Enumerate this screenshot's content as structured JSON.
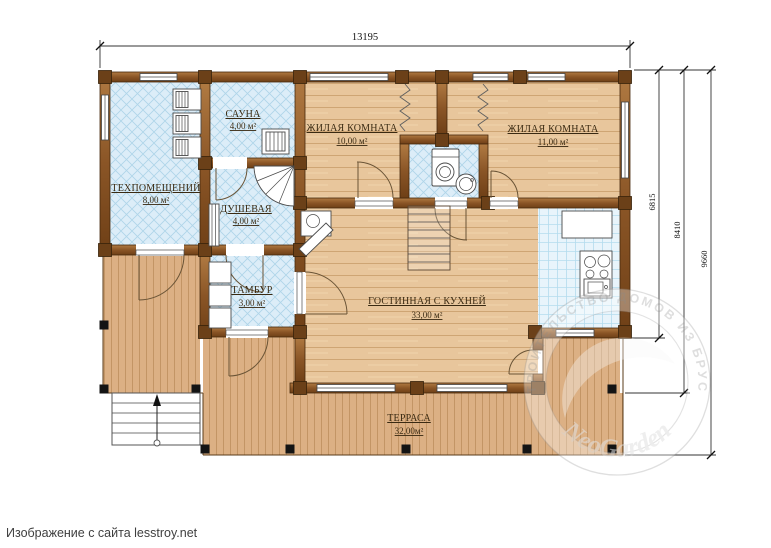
{
  "caption": {
    "text": "Изображение с сайта lesstroy.net"
  },
  "dimensions": {
    "width_top": "13195",
    "right": {
      "d1": "6815",
      "d2": "8410",
      "d3": "9660"
    }
  },
  "rooms": {
    "tech": {
      "name": "ТЕХПОМЕЩЕНИЙ",
      "area": "8,00 м²"
    },
    "sauna": {
      "name": "САУНА",
      "area": "4,00 м²"
    },
    "shower": {
      "name": "ДУШЕВАЯ",
      "area": "4,00 м²"
    },
    "bedroom1": {
      "name": "ЖИЛАЯ КОМНАТА",
      "area": "10,00 м²"
    },
    "bedroom2": {
      "name": "ЖИЛАЯ КОМНАТА",
      "area": "11,00 м²"
    },
    "tambour": {
      "name": "ТАМБУР",
      "area": "3,00 м²"
    },
    "living": {
      "name": "ГОСТИННАЯ С КУХНЕЙ",
      "area": "33,00 м²"
    },
    "terrace": {
      "name": "ТЕРРАСА",
      "area": "32,00м²"
    }
  },
  "watermark": {
    "ring_text": "• СТРОИТЕЛЬСТВО ДОМОВ ИЗ БРУСА •",
    "brand": "NeoGarden"
  },
  "colors": {
    "wall_brown": "#8a5526",
    "wood_floor": "#e8c69c",
    "terrace_floor": "#dcb084",
    "tile_blue": "#dcedf8",
    "label_brown": "#3a2a12"
  }
}
